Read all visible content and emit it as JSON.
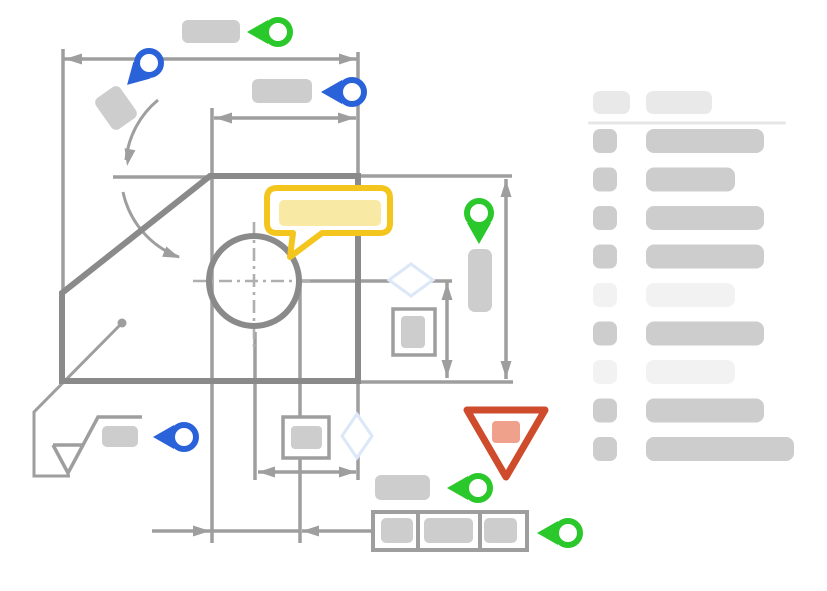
{
  "canvas": {
    "width": 827,
    "height": 591
  },
  "colors": {
    "background": "#ffffff",
    "line": "#9E9E9E",
    "part_outline": "#8A8A8A",
    "centerline": "#AFAFAF",
    "placeholder": "#CDCDCD",
    "placeholder_light": "#F2F2F2",
    "header_chip": "#E9E9E9",
    "divider": "#E6E6E6",
    "green": "#2BC82B",
    "blue": "#2A62D9",
    "yellow": "#F3C51D",
    "yellow_fill": "#F8E9A4",
    "red": "#CE4B2C",
    "red_fill": "#EFA18C",
    "diamond": "#DCE7F8"
  },
  "annotations": {
    "pins": [
      {
        "name": "pin-overall-width",
        "icon": "location-pin-icon",
        "color": "green",
        "x": 278,
        "y": 32,
        "angle": 0
      },
      {
        "name": "pin-chamfer-angle",
        "icon": "location-pin-icon",
        "color": "blue",
        "x": 149,
        "y": 63,
        "angle": -45
      },
      {
        "name": "pin-inner-width",
        "icon": "location-pin-icon",
        "color": "blue",
        "x": 352,
        "y": 92,
        "angle": 0
      },
      {
        "name": "pin-overall-height",
        "icon": "location-pin-icon",
        "color": "green",
        "x": 479,
        "y": 213,
        "angle": -90
      },
      {
        "name": "pin-surface-finish",
        "icon": "location-pin-icon",
        "color": "blue",
        "x": 184,
        "y": 437,
        "angle": 0
      },
      {
        "name": "pin-datum-label",
        "icon": "location-pin-icon",
        "color": "green",
        "x": 478,
        "y": 488,
        "angle": 0
      },
      {
        "name": "pin-feature-control-frame",
        "icon": "location-pin-icon",
        "color": "green",
        "x": 568,
        "y": 533,
        "angle": 0
      }
    ],
    "dimension_labels": [
      {
        "name": "dim-label-overall-width",
        "x": 182,
        "y": 20,
        "w": 58,
        "h": 23,
        "rx": 6,
        "rot": 0
      },
      {
        "name": "dim-label-angle-card",
        "x": 101,
        "y": 89,
        "w": 30,
        "h": 38,
        "rx": 6,
        "rot": -35
      },
      {
        "name": "dim-label-inner-width",
        "x": 252,
        "y": 79,
        "w": 60,
        "h": 24,
        "rx": 6,
        "rot": 0
      },
      {
        "name": "dim-label-height",
        "x": 468,
        "y": 249,
        "w": 24,
        "h": 63,
        "rx": 7,
        "rot": 0
      },
      {
        "name": "dim-label-surface",
        "x": 102,
        "y": 426,
        "w": 36,
        "h": 21,
        "rx": 5,
        "rot": 0
      },
      {
        "name": "dim-label-datum",
        "x": 375,
        "y": 475,
        "w": 55,
        "h": 25,
        "rx": 6,
        "rot": 0
      }
    ],
    "comment_bubble": {
      "name": "comment-bubble",
      "filled_text_placeholder": true
    },
    "warning_triangle": {
      "name": "warning-triangle-icon",
      "filled_text_placeholder": true
    }
  },
  "sidebar": {
    "header": {
      "chips": [
        {
          "w": 37
        },
        {
          "w": 66
        }
      ]
    },
    "rows": [
      {
        "tone": "dark",
        "width": 118
      },
      {
        "tone": "dark",
        "width": 89
      },
      {
        "tone": "dark",
        "width": 118
      },
      {
        "tone": "dark",
        "width": 118
      },
      {
        "tone": "light",
        "width": 89
      },
      {
        "tone": "dark",
        "width": 118
      },
      {
        "tone": "light",
        "width": 89
      },
      {
        "tone": "dark",
        "width": 118
      },
      {
        "tone": "dark",
        "width": 148
      }
    ]
  }
}
